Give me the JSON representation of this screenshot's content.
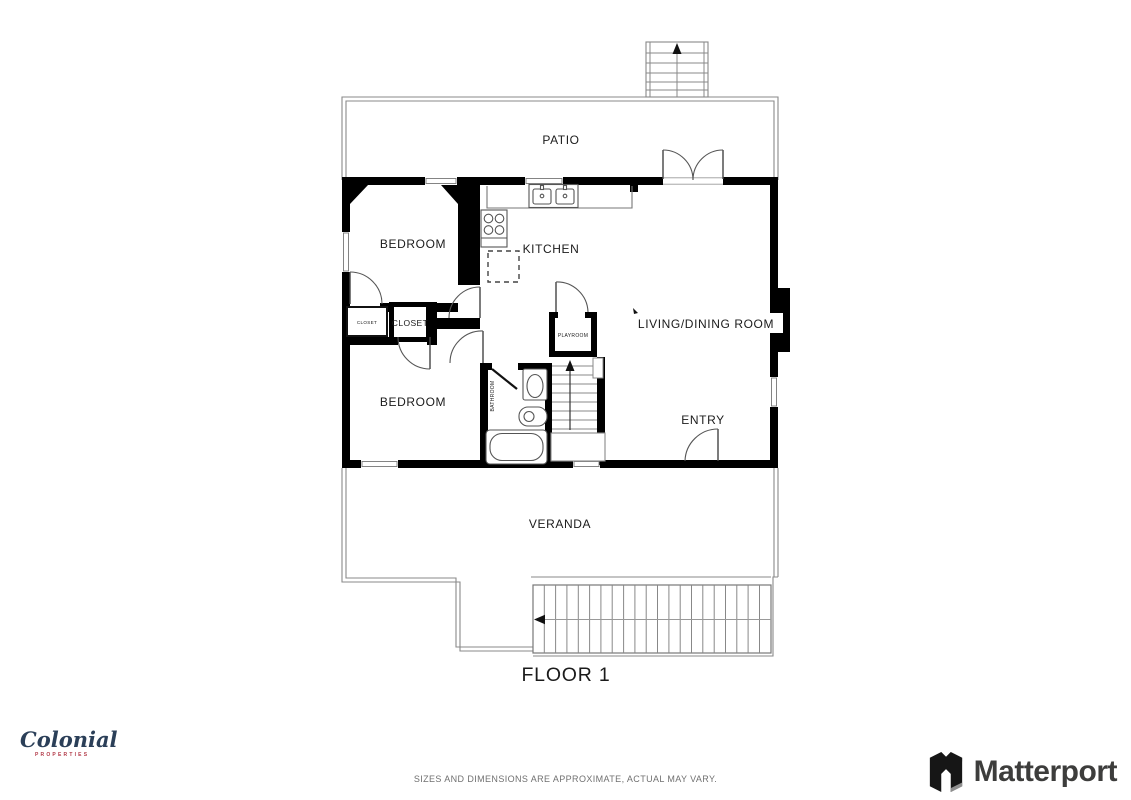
{
  "floor_plan": {
    "floor_label": "FLOOR 1",
    "rooms": {
      "patio": "PATIO",
      "bedroom_top": "BEDROOM",
      "kitchen": "KITCHEN",
      "living_dining": "LIVING/DINING ROOM",
      "closet_small": "CLOSET",
      "closet_large": "CLOSET",
      "playroom": "PLAYROOM",
      "bathroom": "BATHROOM",
      "bedroom_bottom": "BEDROOM",
      "entry": "ENTRY",
      "veranda": "VERANDA"
    }
  },
  "branding": {
    "colonial": {
      "wordmark": "Colonial",
      "subtext": "PROPERTIES",
      "wordmark_color": "#2b3f58",
      "subtext_color": "#b23a48"
    },
    "matterport": {
      "wordmark": "Matterport",
      "color": "#3d3d3c"
    }
  },
  "footer": {
    "disclaimer": "SIZES AND DIMENSIONS ARE APPROXIMATE, ACTUAL MAY VARY."
  },
  "colors": {
    "walls": "#000000",
    "thin_outline": "#8a8a8a",
    "labels": "#1b1b1b"
  }
}
